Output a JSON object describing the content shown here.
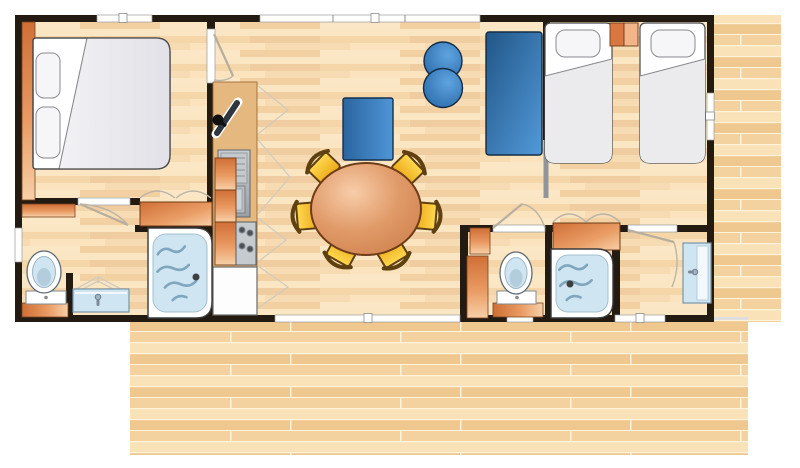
{
  "plan": {
    "type": "mobile-home floor plan, top-down view with wooden terrace deck",
    "rooms": [
      {
        "id": "bedroom-double",
        "furniture": [
          "double-bed",
          "two-pillows",
          "wardrobe-strip",
          "closet-with-bifold-doors"
        ]
      },
      {
        "id": "bathroom-main",
        "furniture": [
          "toilet",
          "washbasin",
          "shower",
          "shelf",
          "window"
        ]
      },
      {
        "id": "kitchen",
        "furniture": [
          "counter",
          "sink-with-drainer",
          "hob-4-burners",
          "fridge",
          "swivel-tv",
          "cupboards"
        ]
      },
      {
        "id": "living-dining",
        "furniture": [
          "sofa",
          "two-poufs",
          "round-dining-table",
          "six-chairs",
          "bay-window",
          "patio-door"
        ]
      },
      {
        "id": "bedroom-twin",
        "furniture": [
          "single-bed",
          "single-bed",
          "nightstand",
          "blue-wardrobe",
          "sliding-door",
          "window"
        ]
      },
      {
        "id": "wc-second",
        "furniture": [
          "toilet",
          "cabinet"
        ]
      },
      {
        "id": "shower-room-second",
        "furniture": [
          "shower",
          "wardrobe-bifold"
        ]
      },
      {
        "id": "washroom-second",
        "furniture": [
          "washbasin"
        ]
      },
      {
        "id": "terrace-deck",
        "furniture": []
      }
    ]
  },
  "colors": {
    "page_bg": "#ffffff",
    "wall": "#231a11",
    "floor_base": "#f7dcb3",
    "deck_base": "#f3d29f",
    "counter_tan": "#e5b87f",
    "counter_border": "#9c6b38",
    "orange_dark": "#cf6f36",
    "orange_mid": "#e99a62",
    "orange_light": "#f7d0a8",
    "orange_border": "#6e3c18",
    "blue_dark": "#215687",
    "blue_mid": "#3478b8",
    "blue_light": "#5299d9",
    "blue_border": "#14304e",
    "table_light": "#f8cda9",
    "table_dark": "#cd7f4b",
    "table_border": "#6e3c18",
    "chair_yellow": "#ffd84f",
    "chair_border": "#5f4010",
    "fixture_blue": "#cfe5f1",
    "fixture_border": "#7795a8",
    "wave_blue": "#7fa6bd",
    "steel": "#b0b6bb",
    "steel_dark": "#60666b",
    "white": "#ffffff",
    "duvet_gray": "#ebebee",
    "outline_gray": "#4a4a4a",
    "arc_gray": "#bdb5a6"
  }
}
